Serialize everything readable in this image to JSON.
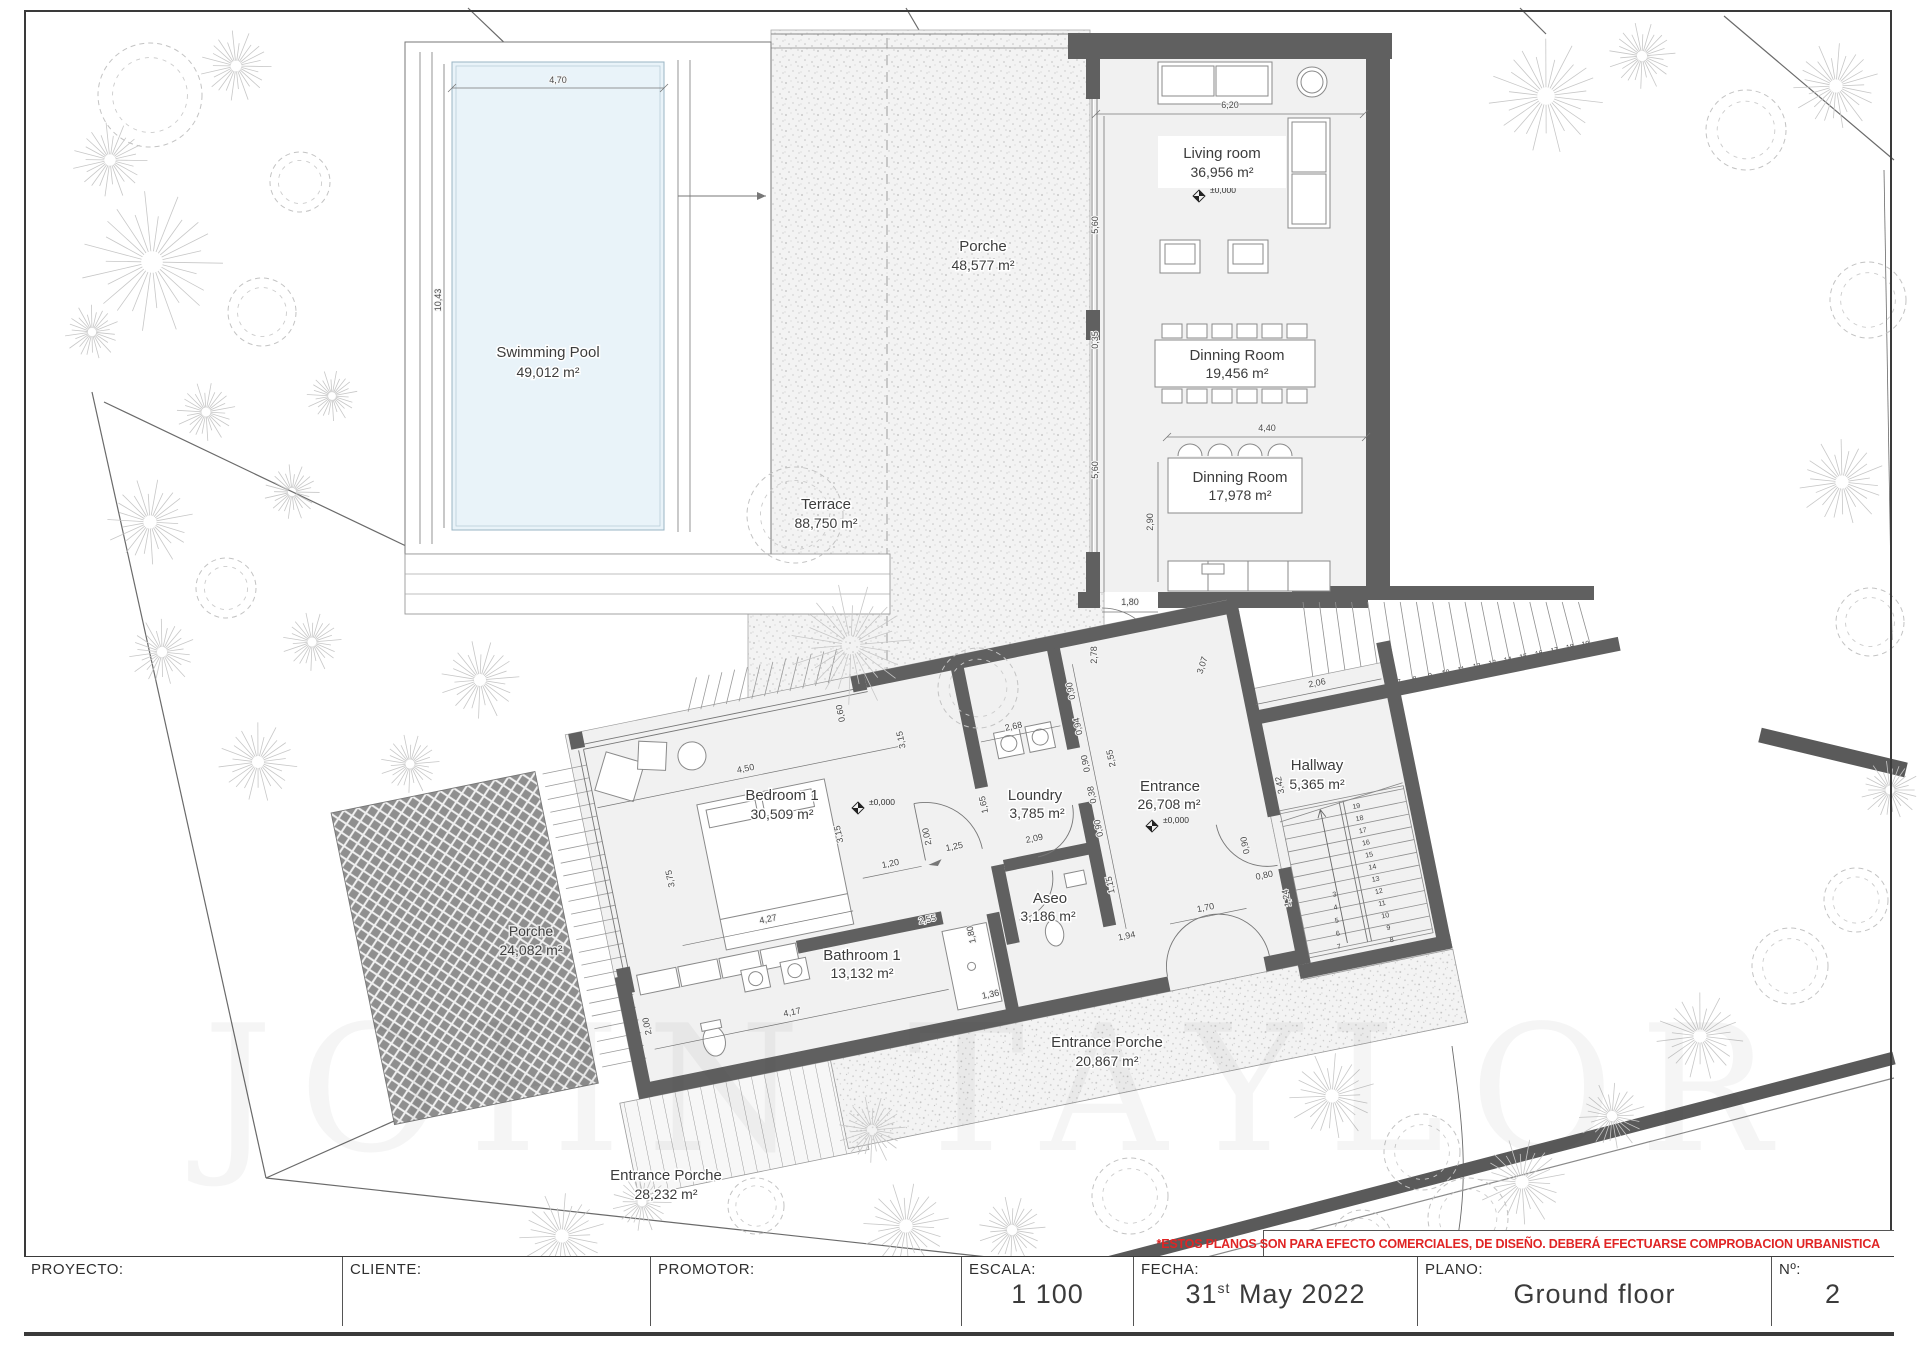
{
  "drawing": {
    "rooms": [
      {
        "name": "Swimming Pool",
        "area": "49,012 m²"
      },
      {
        "name": "Terrace",
        "area": "88,750 m²"
      },
      {
        "name": "Porche",
        "area": "48,577 m²"
      },
      {
        "name": "Living room",
        "area": "36,956 m²"
      },
      {
        "name": "Dinning Room",
        "area": "19,456 m²"
      },
      {
        "name": "Dinning Room",
        "area": "17,978 m²"
      },
      {
        "name": "Bedroom 1",
        "area": "30,509 m²"
      },
      {
        "name": "Loundry",
        "area": "3,785 m²"
      },
      {
        "name": "Aseo",
        "area": "3,186 m²"
      },
      {
        "name": "Bathroom 1",
        "area": "13,132 m²"
      },
      {
        "name": "Entrance",
        "area": "26,708 m²"
      },
      {
        "name": "Hallway",
        "area": "5,365 m²"
      },
      {
        "name": "Porche",
        "area": "24,082 m²"
      },
      {
        "name": "Entrance Porche",
        "area": "28,232 m²"
      },
      {
        "name": "Entrance Porche",
        "area": "20,867 m²"
      }
    ],
    "level_marker": "±0,000",
    "dims": {
      "pool_width": "4,70",
      "pool_length": "10,43",
      "living_width": "6,20",
      "living_depth": "5,60",
      "gap_035": "0,35",
      "dining_depth": "5,60",
      "dining_width": "4,40",
      "dining2_depth": "2,90",
      "door_180": "1,80",
      "wall_278": "2,78",
      "diag_307": "3,07",
      "bedroom_width": "4,50",
      "bedroom_depth": "3,75",
      "corridor_315a": "3,15",
      "corridor_315b": "3,15",
      "bed_width": "4,27",
      "door_120": "1,20",
      "top_060": "0,60",
      "laundry_width": "2,68",
      "laundry_depth": "1,65",
      "laundry_209": "2,09",
      "pass_125": "1,25",
      "strip_200": "2,00",
      "bath_pass_255": "2,55",
      "bath_width": "4,17",
      "bath_depth_200": "2,00",
      "aseo_180": "1,80",
      "w_136": "1,36",
      "ent_090a": "0,90",
      "ent_094": "0,94",
      "ent_090b": "0,90",
      "ent_038": "0,38",
      "ent_090c": "0,90",
      "ent_115": "1,15",
      "ent_194": "1,94",
      "door_170": "1,70",
      "door_080": "0,80",
      "w_124": "1,24",
      "door_090": "0,90",
      "hall_width": "2,06",
      "hall_depth": "3,42",
      "ent_255": "2,55"
    },
    "stairs": {
      "exterior_steps": [
        "2",
        "3",
        "4",
        "5",
        "6",
        "7",
        "8",
        "9",
        "10",
        "11",
        "12",
        "13",
        "14",
        "15",
        "16",
        "17",
        "18",
        "19"
      ],
      "hall_right_steps": [
        "19",
        "18",
        "17",
        "16",
        "15",
        "14",
        "13",
        "12",
        "11",
        "10",
        "9",
        "8"
      ],
      "hall_left_steps": [
        "3",
        "4",
        "5",
        "6",
        "7"
      ]
    },
    "watermark": "JOHN TAYLOR"
  },
  "disclaimer": "*ESTOS PLANOS SON PARA EFECTO COMERCIALES, DE DISEÑO. DEBERÁ EFECTUARSE COMPROBACION URBANISTICA",
  "titleblock": {
    "proyecto_label": "PROYECTO:",
    "cliente_label": "CLIENTE:",
    "promotor_label": "PROMOTOR:",
    "escala_label": "ESCALA:",
    "escala_value": "1 100",
    "fecha_label": "FECHA:",
    "fecha_day": "31",
    "fecha_ordinal": "st",
    "fecha_rest": "May 2022",
    "plano_label": "PLANO:",
    "plano_value": "Ground floor",
    "numero_label": "Nº:",
    "numero_value": "2"
  }
}
